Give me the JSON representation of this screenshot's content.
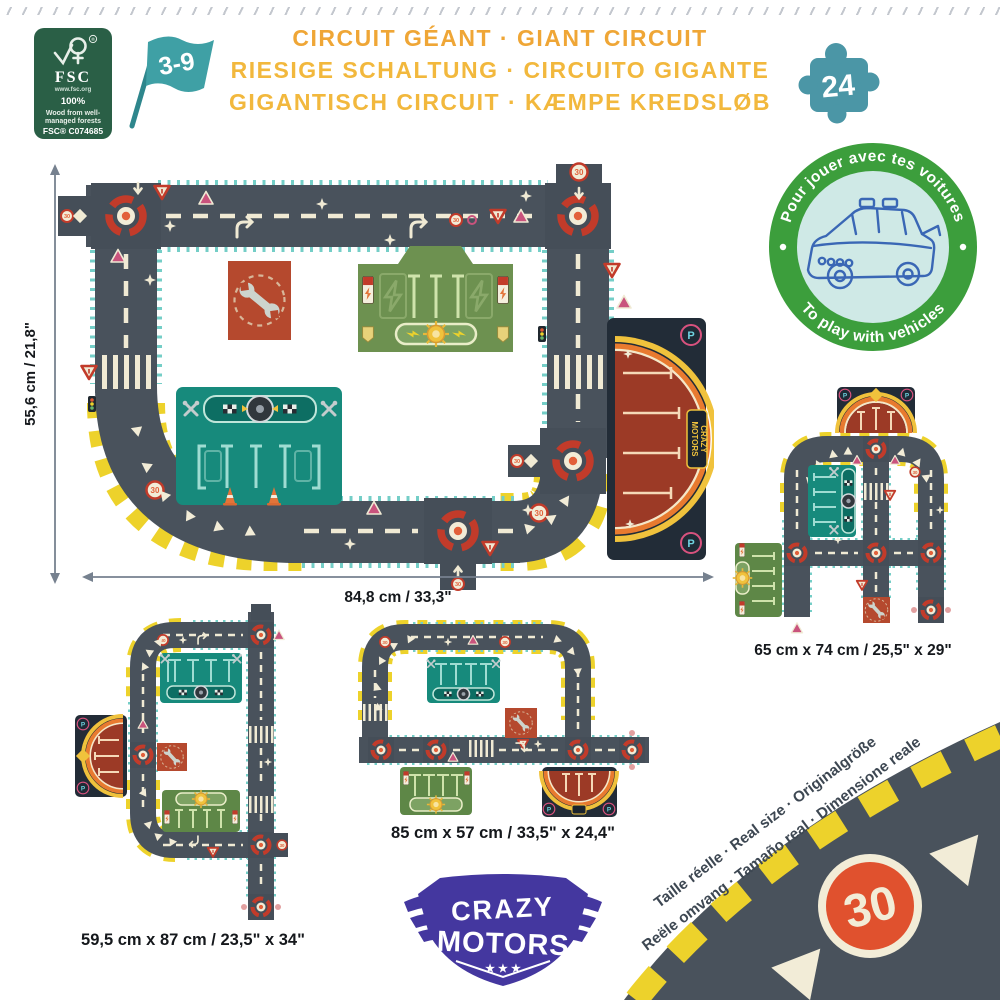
{
  "header": {
    "fsc": {
      "brand": "FSC",
      "reg": "®",
      "url": "www.fsc.org",
      "percent": "100%",
      "desc_line1": "Wood from well-",
      "desc_line2": "managed forests",
      "license": "FSC® C074685"
    },
    "age_range": "3-9",
    "title_line1": "CIRCUIT GÉANT · GIANT CIRCUIT",
    "title_line2": "RIESIGE SCHALTUNG · CIRCUITO GIGANTE",
    "title_line3": "GIGANTISCH CIRCUIT · KÆMPE KREDSLØB",
    "pieces_count": "24"
  },
  "play_badge": {
    "text_top": "Pour jouer avec tes voitures",
    "text_bottom": "To play with vehicles"
  },
  "main_circuit": {
    "height_label": "55,6 cm / 21,8\"",
    "width_label": "84,8 cm / 33,3\"",
    "speed_sign": "30",
    "parking_letter": "P"
  },
  "brand": {
    "word_top": "CRAZY",
    "word_bottom": "MOTORS",
    "stars": "★ ★ ★"
  },
  "variant_right": {
    "size_label": "65 cm x 74 cm / 25,5\" x 29\""
  },
  "variant_middle": {
    "size_label": "85 cm x 57 cm / 33,5\" x 24,4\""
  },
  "variant_left": {
    "size_label": "59,5 cm x 87 cm / 23,5\" x 34\""
  },
  "real_size": {
    "label_line1": "Taille réelle · Real size · Originalgröße",
    "label_line2": "Reële omvang · Tamaño real · Dimensione reale",
    "speed_sign": "30"
  },
  "colors": {
    "road": "#49525c",
    "teal_edge": "#74cec7",
    "hazard_yellow": "#edd22b",
    "cream": "#f0ead4",
    "signal_red": "#c23b2a",
    "station_green": "#6d9150",
    "garage_teal": "#178a7c",
    "parking_red": "#9c3a26",
    "wrench_tile_red": "#b5492e",
    "badge_green": "#3c9e3c",
    "badge_inner_blue": "#cfe9e6",
    "brand_indigo": "#44379f",
    "title_orange": "#efa636",
    "title_yellow": "#f2b83d",
    "fsc_green": "#2a5f46",
    "flag_teal": "#3fa0a5"
  }
}
